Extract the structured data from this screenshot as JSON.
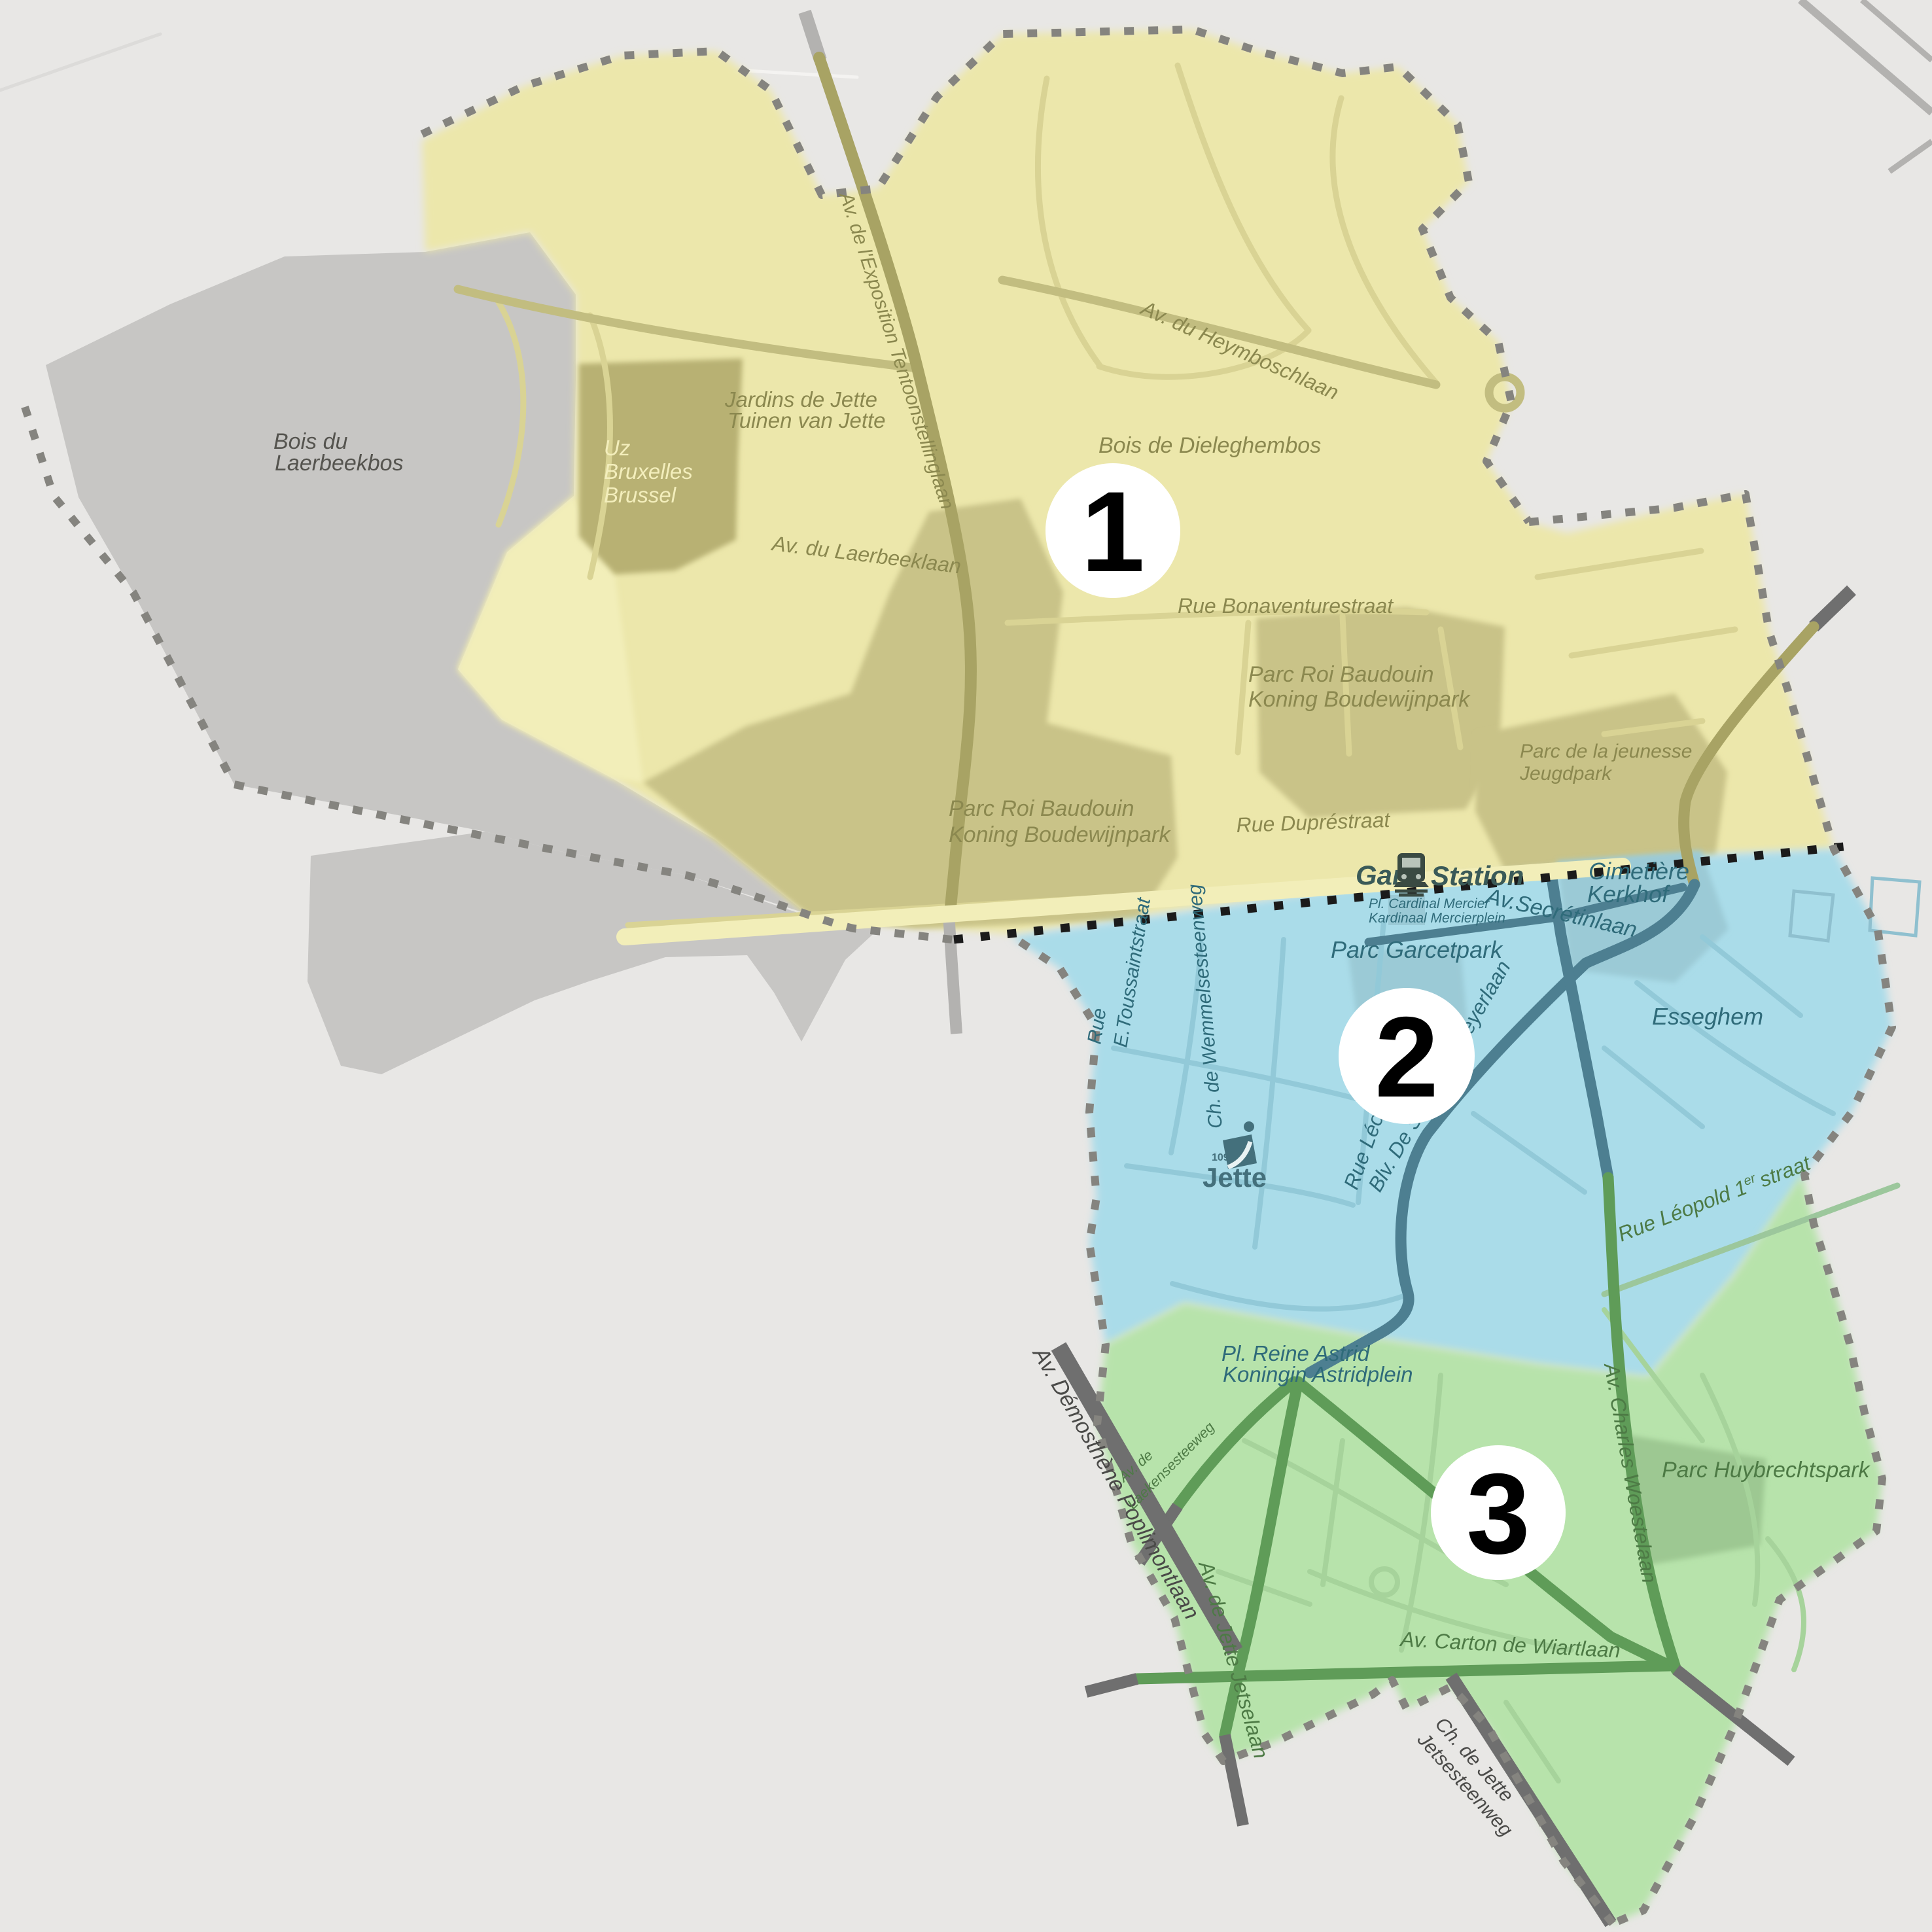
{
  "title": "Jette municipality zone map",
  "zones": [
    {
      "id": "zone-1",
      "number": "1",
      "ring": "#f2e20a"
    },
    {
      "id": "zone-2",
      "number": "2",
      "ring": "#2cbdea"
    },
    {
      "id": "zone-3",
      "number": "3",
      "ring": "#3fdd11"
    }
  ],
  "labels": {
    "bois1": "Bois du",
    "bois2": "Laerbeekbos",
    "uz1": "Uz",
    "uz2": "Bruxelles",
    "uz3": "Brussel",
    "jardins1": "Jardins de Jette",
    "jardins2": "Tuinen van Jette",
    "exposition": "Av. de l'Exposition Tentoonstellinglaan",
    "heymbosch": "Av. du Heymboschlaan",
    "dieleghem": "Bois de Dieleghembos",
    "laerbeeklaan": "Av. du Laerbeeklaan",
    "bonaventure": "Rue Bonaventurestraat",
    "prb_a": "Parc Roi Baudouin",
    "prb_b": "Koning Boudewijnpark",
    "jeunesse1": "Parc de la jeunesse",
    "jeunesse2": "Jeugdpark",
    "dupre": "Rue Dupréstraat",
    "gare": "Gare",
    "station": "Station",
    "mercier1": "Pl. Cardinal Mercier",
    "mercier2": "Kardinaal Mercierplein",
    "secretin": "Av.Secrétinlaan",
    "cimetiere1": "Cimetière",
    "cimetiere2": "Kerkhof",
    "garcet": "Parc Garcetpark",
    "esseghem": "Esseghem",
    "toussaint1": "Rue",
    "toussaint2": "E.Toussaintstraat",
    "wemmel": "Ch. de Wemmelsesteenweg",
    "leon": "Rue Léon",
    "smet": "Blv. De Smet de Naeyerlaan",
    "leopold1": "Rue Léopold 1",
    "leopold_sup": "er",
    "leopold2": "straat",
    "astrid1": "Pl. Reine Astrid",
    "astrid2": "Koningin Astridplein",
    "poplimont": "Av. Démosthène Poplimontlaan",
    "laeken1": "Av. de",
    "laeken2": "Laekensesteeweg",
    "avjette": "Av. de Jette Jetselaan",
    "woeste": "Av. Charles Woestelaan",
    "huybrechts": "Parc Huybrechtspark",
    "carton": "Av. Carton de Wiartlaan",
    "chjette1": "Ch. de Jette",
    "chjette2": "Jetsesteenweg"
  },
  "logo": {
    "postcode": "1090",
    "name": "Jette"
  },
  "colors": {
    "bg": "#e8e7e5",
    "gray-zone": "#c7c6c4",
    "yellow-zone": "#ece7ab",
    "blue-zone": "#aadce9",
    "green-zone": "#b7e3ab",
    "yellow-park": "#c9c388",
    "uz-park": "#b8b173",
    "blue-park": "#9bcad6",
    "green-park": "#9dc892",
    "pale-yellow": "#f2eeb9",
    "road-yellow": "#d9d394",
    "road-yellow-main": "#c2bd80",
    "road-olive": "#a8a364",
    "road-blue": "#92c9d8",
    "road-blue-main": "#4d7f91",
    "road-green": "#a6d39b",
    "road-green-main": "#5f9c58",
    "road-out": "#6f6f6f",
    "road-out-light": "#b3b2b0",
    "road-white": "#f4f3f1",
    "railway": "#1b1b1b",
    "boundary": "#85847f",
    "t-yellow": "#8b884f",
    "t-gray": "#55544f",
    "t-blue": "#2f6b7a",
    "t-green": "#4d7a45",
    "t-out": "#4a4a48",
    "t-uz": "#f3eebc",
    "t-station": "#3a5a58",
    "logo-teal": "#44707c"
  }
}
